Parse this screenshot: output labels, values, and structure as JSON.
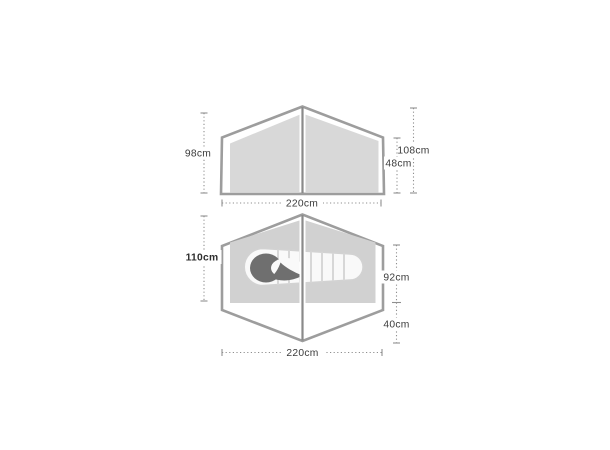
{
  "diagram": {
    "type": "tent-dimension-diagram",
    "views": [
      "side-elevation",
      "floor-plan"
    ]
  },
  "side_view": {
    "labels": {
      "height_left": "98cm",
      "height_peak": "108cm",
      "height_wall": "48cm",
      "width": "220cm"
    }
  },
  "floor_plan": {
    "labels": {
      "width_inner": "110cm",
      "depth_inner": "92cm",
      "depth_porch": "40cm",
      "length": "220cm"
    }
  },
  "icons": {
    "sleeping_bag": "sleeping-bag-icon"
  },
  "colors": {
    "background": "#ffffff",
    "outline": "#9d9d9d",
    "canopy_fill": "#d8d8d8",
    "floor_fill": "#d1d1d1",
    "pole": "#8a8a8a",
    "dimension_line": "#8f8f8f",
    "label_text": "#3c3c3c",
    "sleeping_bag_body": "#f9f9f9",
    "sleeping_bag_hood": "#6f6f6f"
  }
}
